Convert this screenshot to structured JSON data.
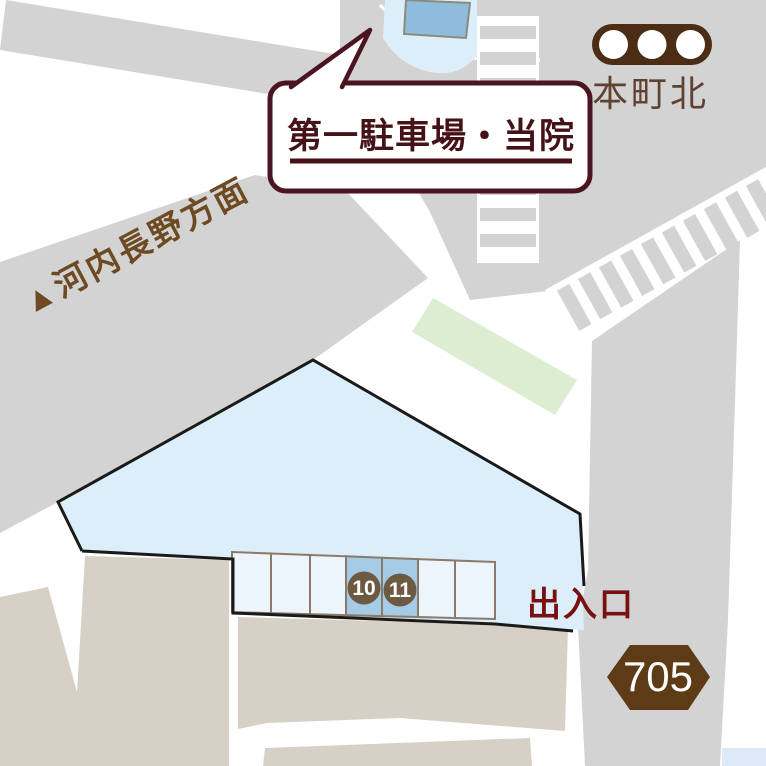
{
  "labels": {
    "callout": "第一駐車場・当院",
    "intersection": "本町北",
    "direction": "▲河内長野方面",
    "entrance": "出入口",
    "route_number": "705",
    "stall_10": "10",
    "stall_11": "11"
  },
  "colors": {
    "road_gray": "#d3d3d3",
    "block_beige": "#d6d0c6",
    "site_blue": "#dceefa",
    "stall_blue": "#edf5fc",
    "stall_highlight_blue": "#a6cbe6",
    "building_blue": "#8fbcdc",
    "green_strip": "#dcedd2",
    "traffic_light_brown": "#4a2d14",
    "route_badge_brown": "#5d3b16",
    "stall_circle_brown": "#6d5a42",
    "callout_maroon": "#4a1420",
    "entrance_red": "#7b1012",
    "intersection_text_brown": "#5e4130",
    "direction_text_brown": "#6d4a22"
  }
}
